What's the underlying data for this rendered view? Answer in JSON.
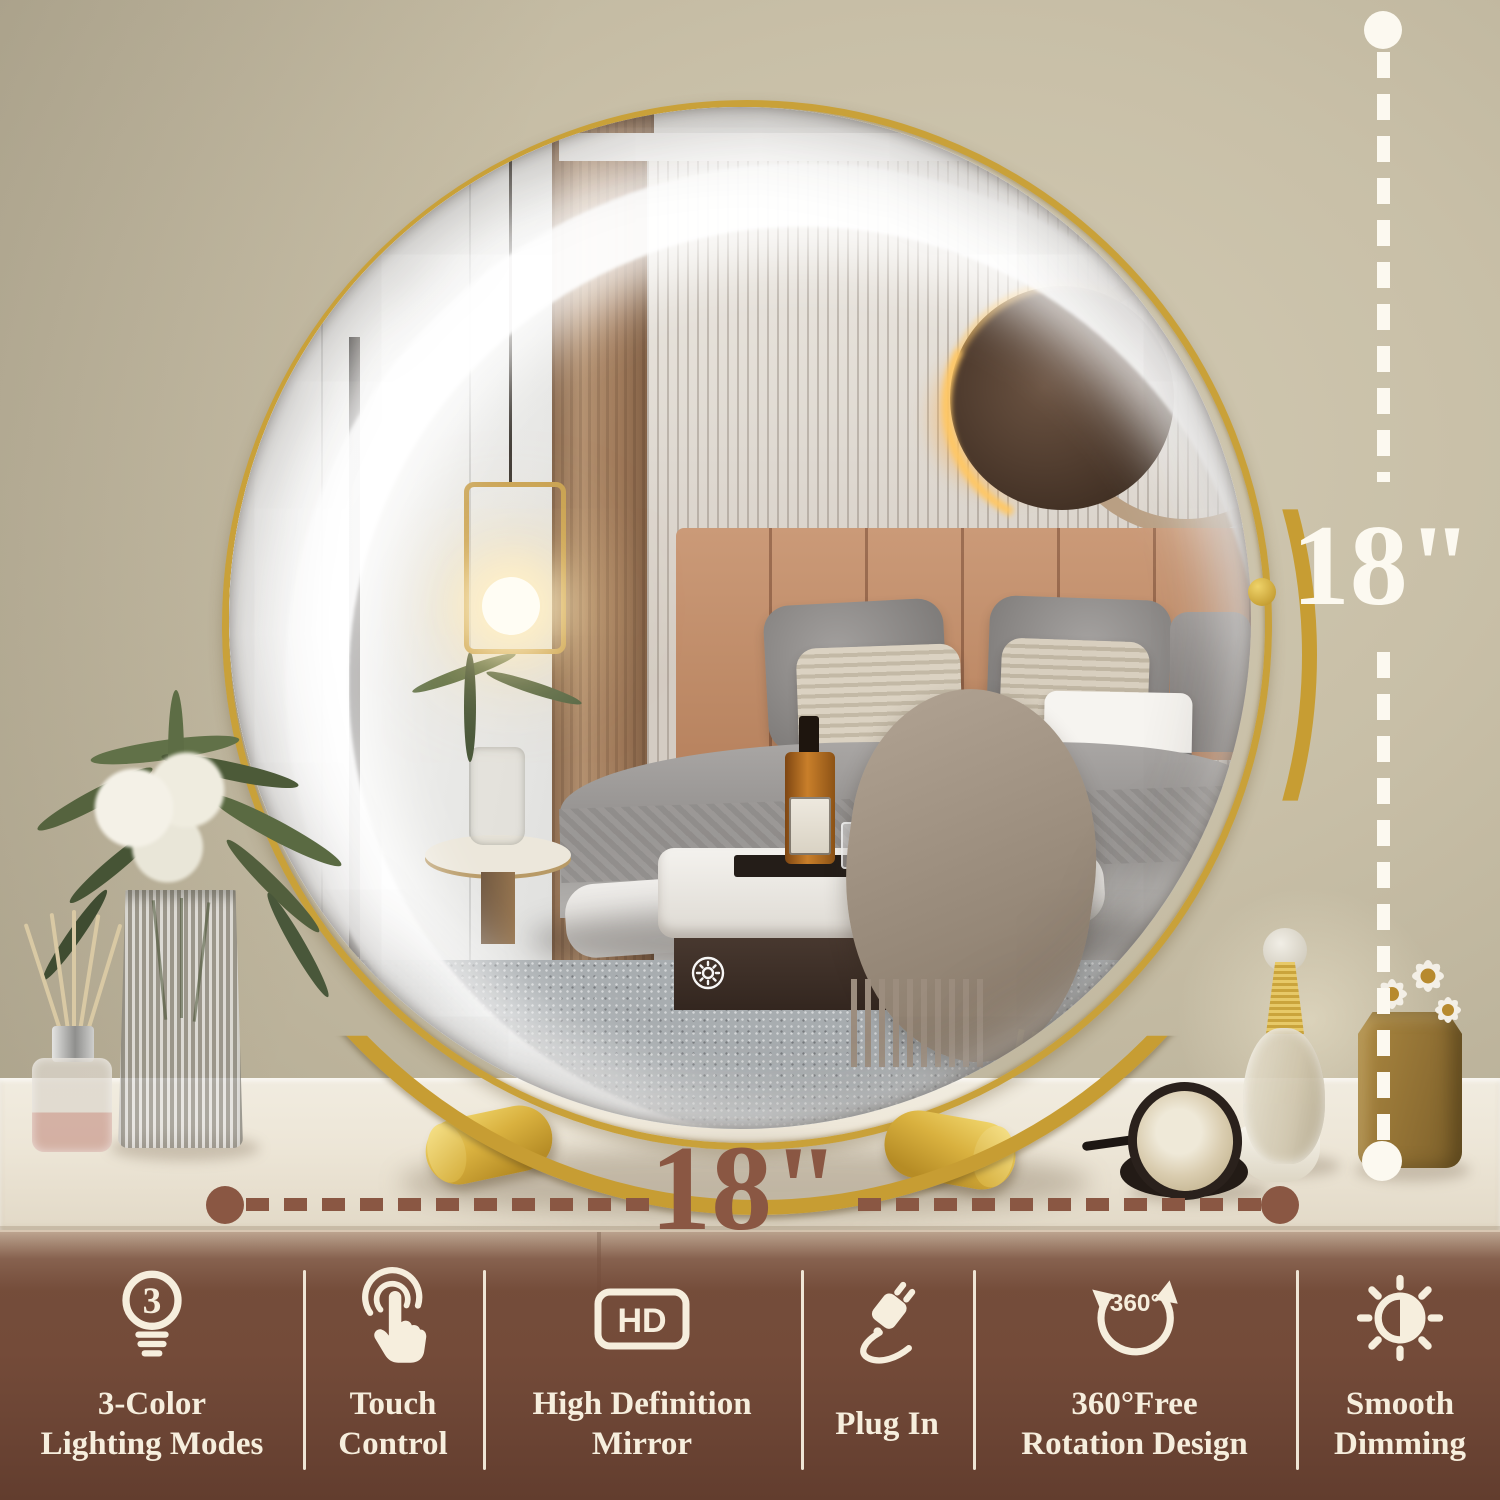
{
  "title": "18 inch LED round vanity mirror product infographic",
  "dimensions": {
    "width_label": "18\"",
    "height_label": "18\""
  },
  "mirror": {
    "touch_button_icon": "sun-dimmer-touch-icon",
    "frame_color": "#c9a139",
    "led_color": "#ffffff"
  },
  "feature_bar": {
    "background_color": "#6f4736",
    "text_color": "#f6eedd",
    "items": [
      {
        "icon": "bulb-3-modes-icon",
        "icon_text": "3",
        "line1": "3-Color",
        "line2": "Lighting Modes"
      },
      {
        "icon": "touch-finger-icon",
        "icon_text": "",
        "line1": "Touch",
        "line2": "Control"
      },
      {
        "icon": "hd-badge-icon",
        "icon_text": "HD",
        "line1": "High Definition",
        "line2": "Mirror"
      },
      {
        "icon": "power-plug-icon",
        "icon_text": "",
        "line1": "Plug In",
        "line2": ""
      },
      {
        "icon": "rotate-360-icon",
        "icon_text": "360°",
        "line1": "360°Free",
        "line2": "Rotation Design"
      },
      {
        "icon": "half-sun-dimming-icon",
        "icon_text": "",
        "line1": "Smooth",
        "line2": "Dimming"
      }
    ]
  },
  "annotation_colors": {
    "horizontal_line": "#8a5743",
    "vertical_line": "#fcf9f0"
  }
}
